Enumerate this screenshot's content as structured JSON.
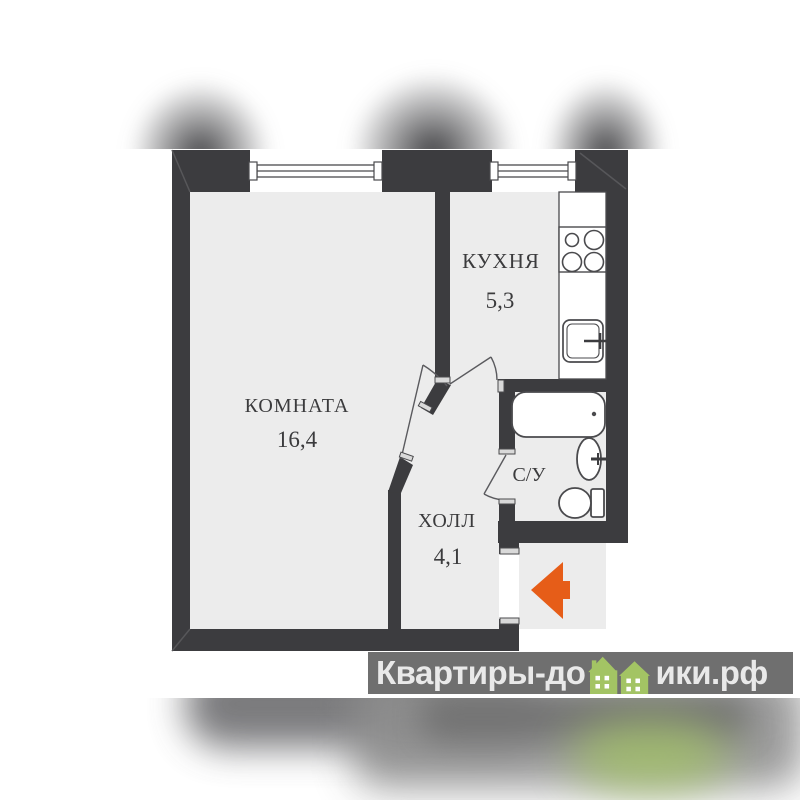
{
  "plan": {
    "rooms": [
      {
        "name": "КОМНАТА",
        "area": "16,4"
      },
      {
        "name": "КУХНЯ",
        "area": "5,3"
      },
      {
        "name": "ХОЛЛ",
        "area": "4,1"
      },
      {
        "name": "С/У",
        "area": ""
      }
    ]
  },
  "watermark": {
    "text_before_houses": "Квартиры-до",
    "text_after_houses": "ики.рф"
  },
  "colors": {
    "wall": "#3c3c3f",
    "floor": "#ececec",
    "fixture_stroke": "#4a4a4d",
    "entrance_arrow_orange": "#e65d18",
    "logo_bar_gray": "#6f6f6f",
    "logo_text_gray": "#e9e9e9",
    "logo_house_green": "#a3c464"
  },
  "icons": {
    "window-icon": "double-line window in wall",
    "stove-icon": "4 burner circles",
    "kitchen-sink-icon": "square sink with faucet",
    "bathtub-icon": "rounded rectangle tub with drain dot",
    "washbasin-icon": "oval basin with faucet",
    "toilet-icon": "bowl with tank",
    "door-swing-icon": "door leaf with swing arc",
    "entrance-arrow-icon": "orange left-pointing arrow",
    "house-icon": "green houses replacing letters in watermark"
  }
}
